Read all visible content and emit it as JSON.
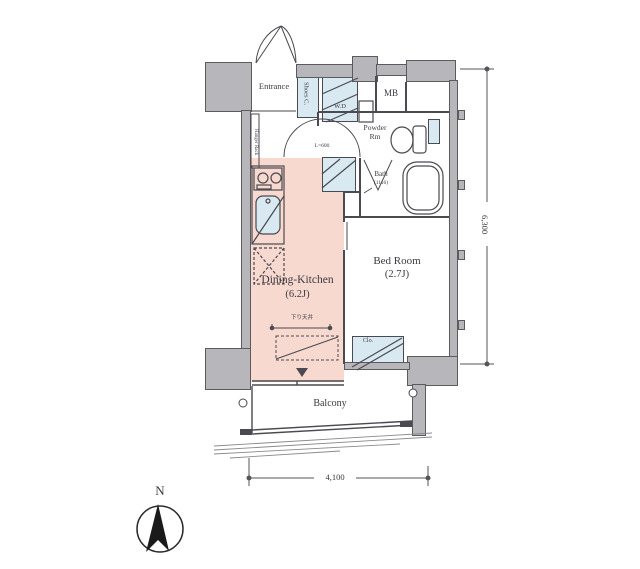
{
  "floorplan": {
    "rooms": {
      "entrance": {
        "label": "Entrance"
      },
      "shoes_closet": {
        "label": "Shoes C."
      },
      "washer_dryer": {
        "label": "W.D"
      },
      "meter_box": {
        "label": "MB"
      },
      "powder_room": {
        "line1": "Powder",
        "line2": "Rm"
      },
      "bath": {
        "label": "Bath",
        "size": "(1116)"
      },
      "dining_kitchen": {
        "label": "Dining-Kitchen",
        "size": "(6.2J)",
        "ceiling_note": "下り天井"
      },
      "bedroom": {
        "label": "Bed Room",
        "size": "(2.7J)"
      },
      "closet": {
        "label": "Clo."
      },
      "balcony": {
        "label": "Balcony"
      },
      "hanger_rack": {
        "label": "Hanger Rack"
      }
    },
    "annotations": {
      "opening_width": "L=600"
    },
    "dimensions": {
      "width": "4,100",
      "height": "6,300"
    },
    "compass": {
      "north": "N"
    },
    "colors": {
      "wall": "#b7b7bb",
      "wall_edge": "#5a5a5f",
      "line": "#4a4a50",
      "dining_kitchen_fill": "#f8d9cf",
      "fixture_fill": "#d8e9f2"
    }
  }
}
